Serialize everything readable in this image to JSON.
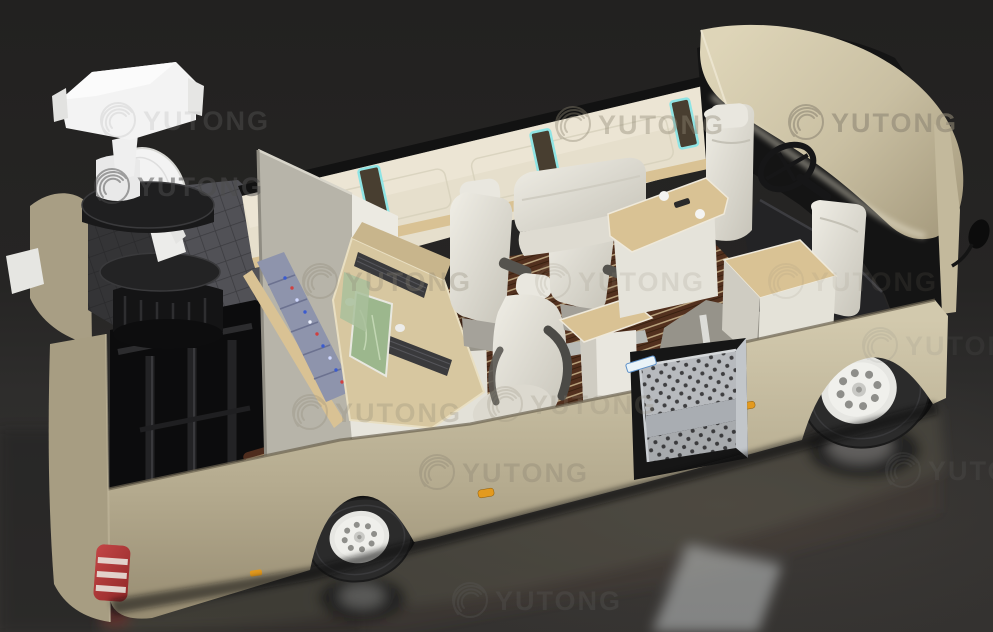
{
  "watermark": {
    "text": "YUTONG"
  },
  "colors": {
    "background_top": "#232222",
    "background_bottom": "#333130",
    "body_beige": "#c6bc9f",
    "body_shadow": "#a79d82",
    "roof_beige": "#d5ccb0",
    "wall_cream": "#e6dfcc",
    "trim_wood": "#d9c294",
    "floor_wood": "#52301e",
    "floor_wood_stripe": "#c9b48c",
    "seat_white": "#e9e7df",
    "equipment_white": "#f3f3f3",
    "rack_blue": "#8e94ac",
    "screen_green": "#9cb78d",
    "cyan_trim": "#8fe4e4",
    "taillight_red": "#b03636",
    "marker_amber": "#e39a1e",
    "tire_dark": "#2b2b2b",
    "rim_white": "#e6e6e2",
    "cab_dark": "#141414",
    "watermark_gray": "#8f8775"
  }
}
